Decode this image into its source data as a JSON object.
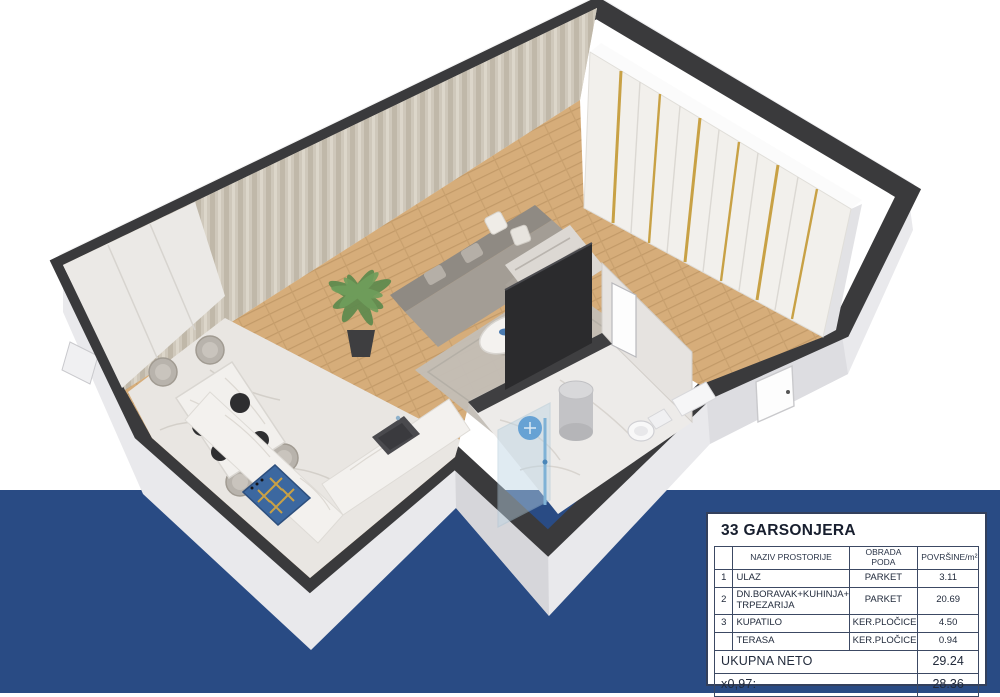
{
  "page": {
    "background_color": "#ffffff",
    "band_color": "#294b84"
  },
  "illustration": {
    "type": "3d-floor-plan-render",
    "colors": {
      "wall_top": "#3a3a3c",
      "wall_face": "#e9e9ec",
      "parquet": "#d6ad7a",
      "marble": "#eceae8",
      "wardrobe_gold": "#c8a145",
      "cooktop_blue": "#3c68a0",
      "sofa_gray": "#a39d95"
    },
    "elements": [
      "exterior-walls",
      "curtain-wall",
      "wardrobe",
      "parquet-floor",
      "living-rug",
      "sofa",
      "coffee-table",
      "potted-plant",
      "dining-table",
      "dining-chairs",
      "kitchen-counter",
      "cooktop",
      "kitchen-sink",
      "bathroom",
      "shower",
      "water-heater",
      "toilet",
      "entrance-door",
      "bathroom-door",
      "tv-panel"
    ]
  },
  "info_table": {
    "title": "33 GARSONJERA",
    "columns": {
      "num": "",
      "name": "NAZIV PROSTORIJE",
      "floor": "OBRADA PODA",
      "area": "POVRŠINE/m²"
    },
    "rows": [
      {
        "num": "1",
        "name": "ULAZ",
        "floor": "PARKET",
        "area": "3.11"
      },
      {
        "num": "2",
        "name": "DN.BORAVAK+KUHINJA+\nTRPEZARIJA",
        "floor": "PARKET",
        "area": "20.69"
      },
      {
        "num": "3",
        "name": "KUPATILO",
        "floor": "KER.PLOČICE",
        "area": "4.50"
      },
      {
        "num": "",
        "name": "TERASA",
        "floor": "KER.PLOČICE",
        "area": "0.94"
      }
    ],
    "totals": [
      {
        "label": "UKUPNA NETO",
        "value": "29.24"
      },
      {
        "label": "x0,97:",
        "value": "28.36"
      }
    ]
  }
}
